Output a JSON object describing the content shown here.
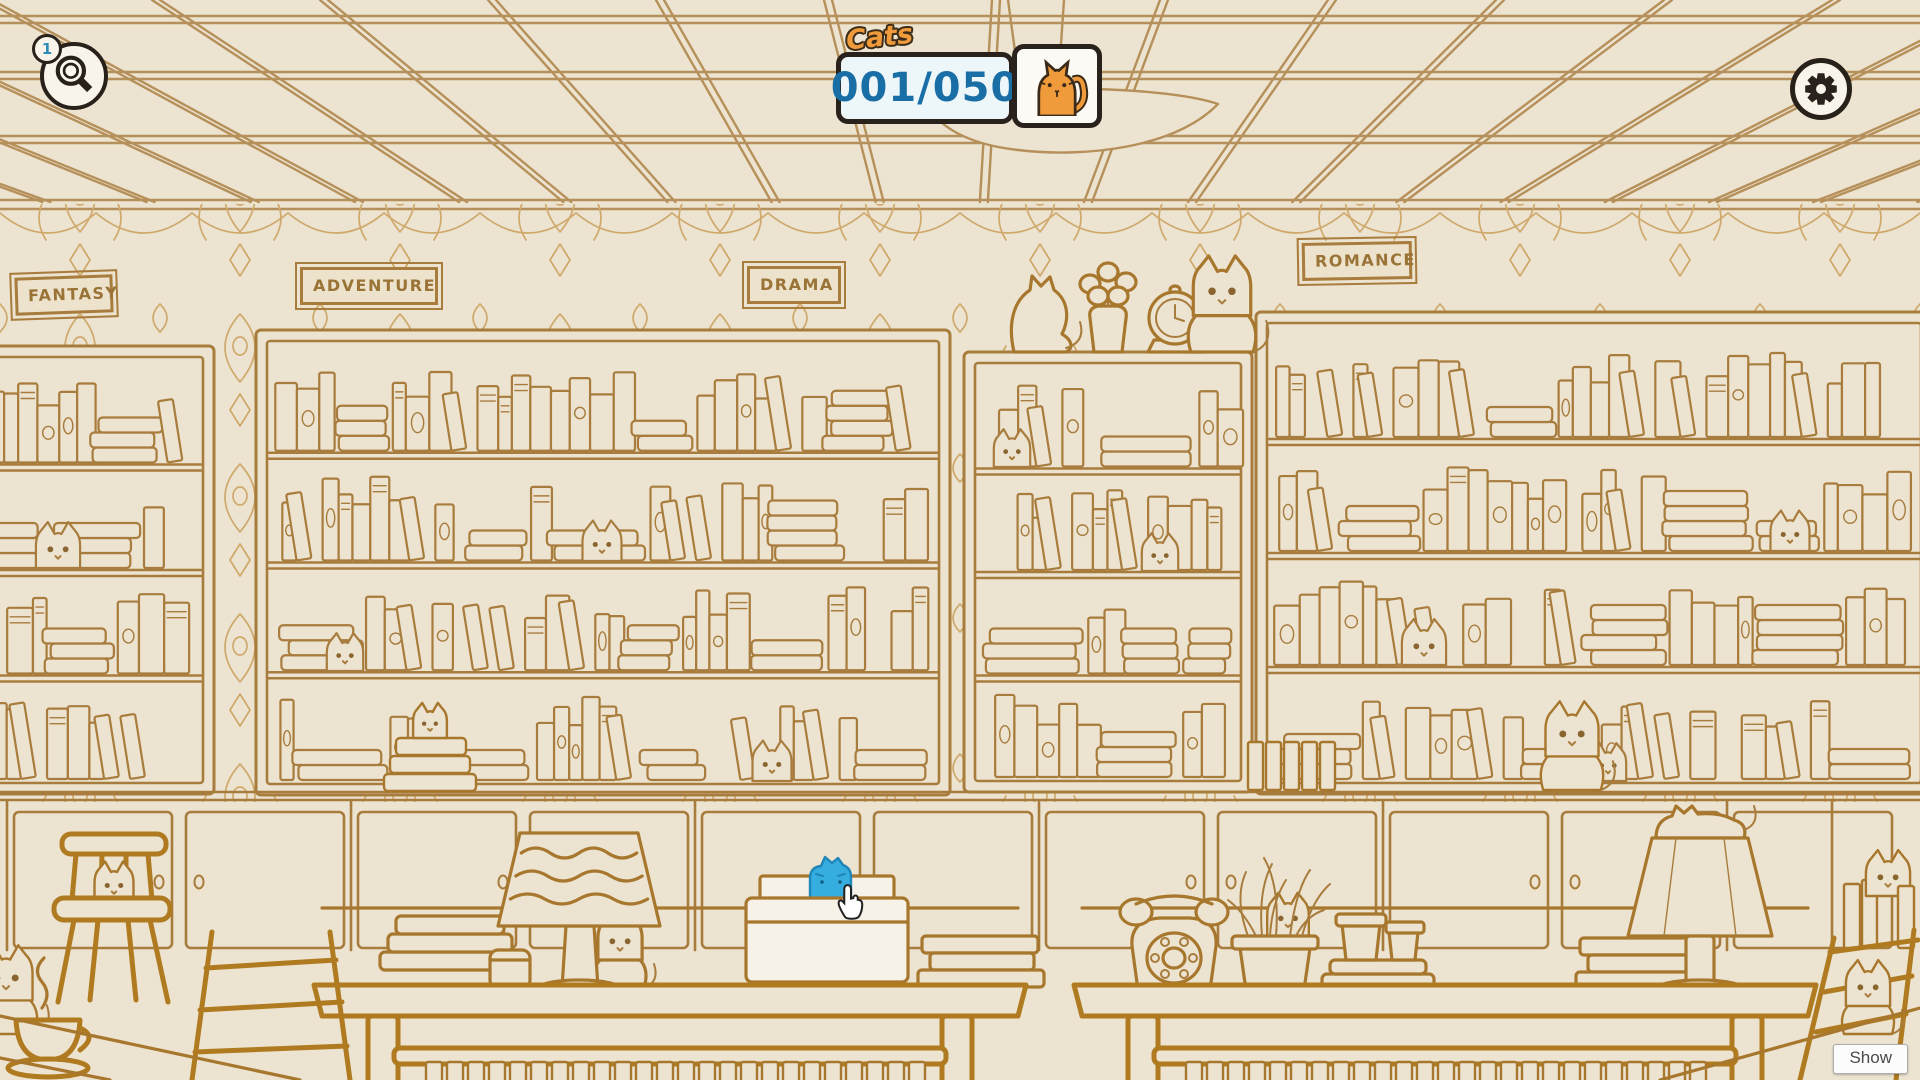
{
  "hud": {
    "hint_button": {
      "badge_count": "1",
      "icon": "magnifier-icon"
    },
    "cat_counter": {
      "label": "Cats",
      "value": "001/050",
      "icon": "cat-icon"
    },
    "settings_button": {
      "icon": "gear-icon"
    },
    "show_button": {
      "label": "Show"
    }
  },
  "shelf_labels": {
    "fantasy": "FANTASY",
    "adventure": "ADVENTURE",
    "drama": "DRAMA",
    "romance": "ROMANCE"
  },
  "colors": {
    "background": "#ece3d0",
    "line_art": "#a87c3d",
    "counter_text": "#1a6ea6",
    "cat_orange": "#ef9b3c",
    "found_cat_blue": "#36addf"
  }
}
